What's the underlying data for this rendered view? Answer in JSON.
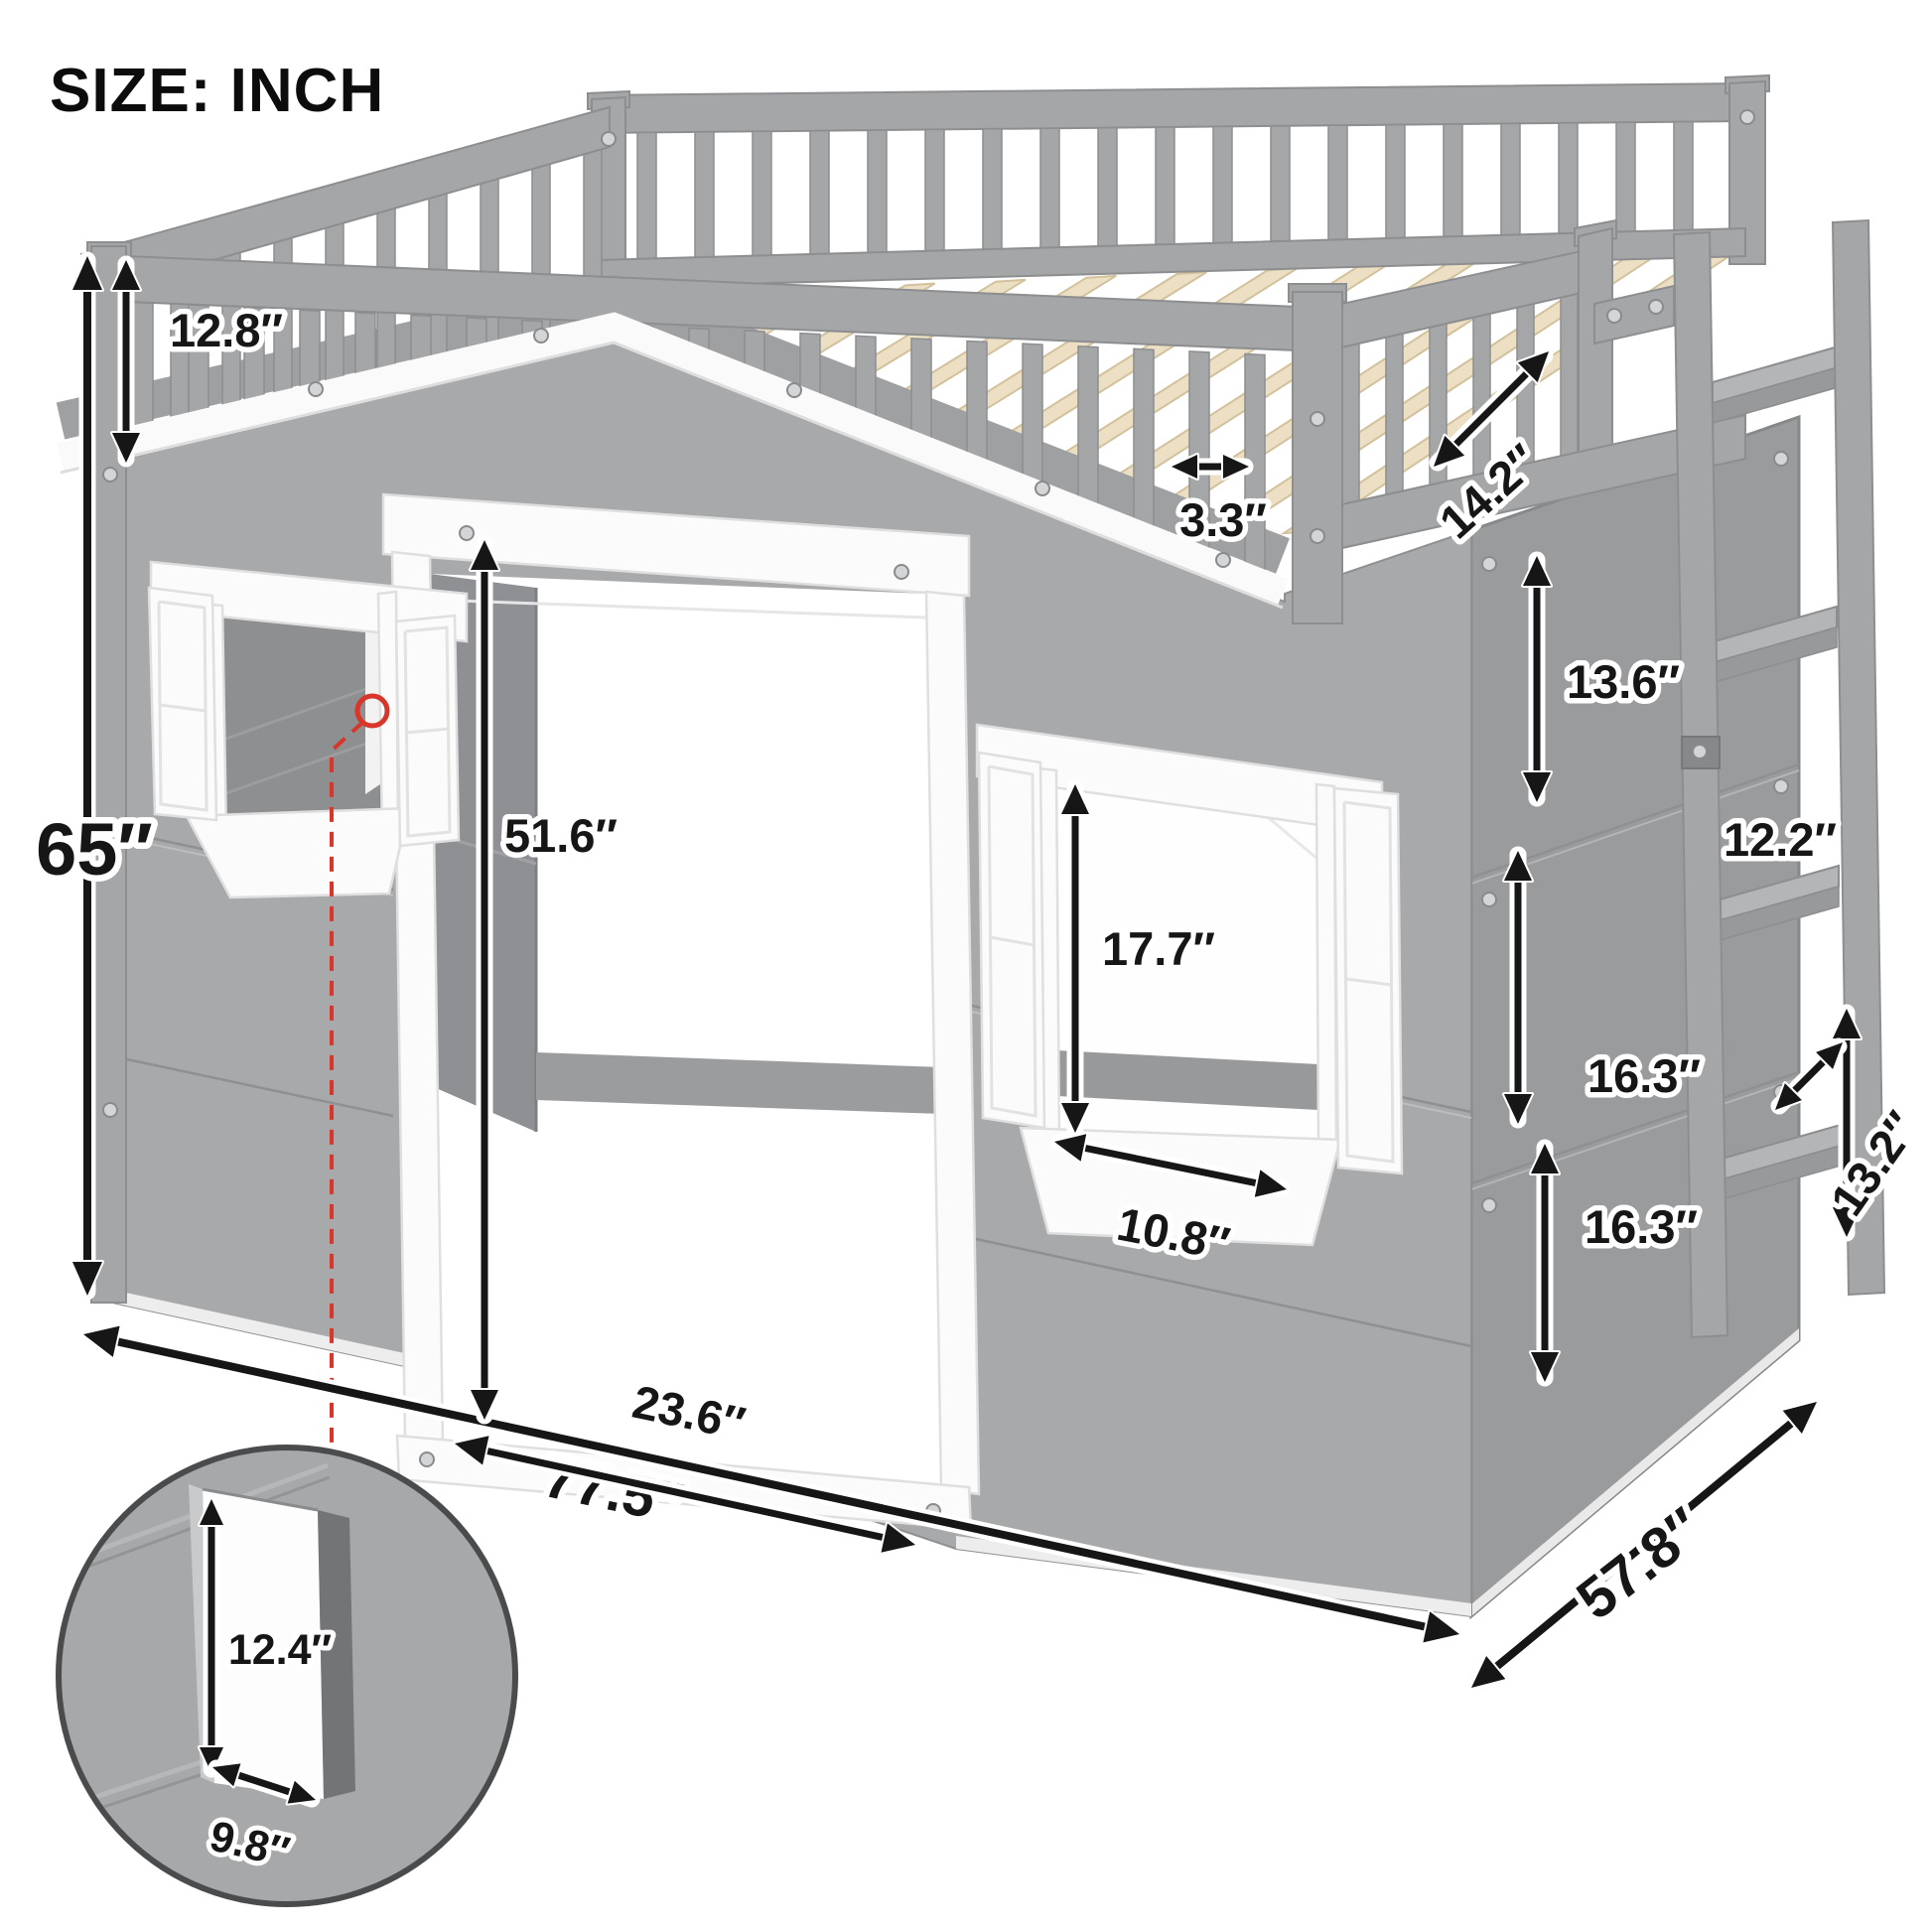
{
  "title": "SIZE: INCH",
  "dimensions": {
    "rail_height": "12.8″",
    "overall_height": "65″",
    "guardrail_depth": "14.2″",
    "slat_spacing": "3.3″",
    "side_panel_upper": "13.6″",
    "ladder_step_spacing": "12.2″",
    "side_panel_middle": "16.3″",
    "ladder_depth": "13.2″",
    "side_panel_lower": "16.3″",
    "door_height": "51.6″",
    "window_height": "17.7″",
    "window_width": "10.8″",
    "door_width": "23.6″",
    "overall_width": "77.5″",
    "overall_depth": "57.8″",
    "detail_window_height": "12.4″",
    "detail_window_width": "9.8″"
  },
  "colors": {
    "wall_front": "#a8a9ab",
    "wall_side": "#9a9b9d",
    "white_trim": "#fbfbfb",
    "slat_wood": "#ecdfc4",
    "annotation": "#161616",
    "callout_red": "#d8352b"
  }
}
